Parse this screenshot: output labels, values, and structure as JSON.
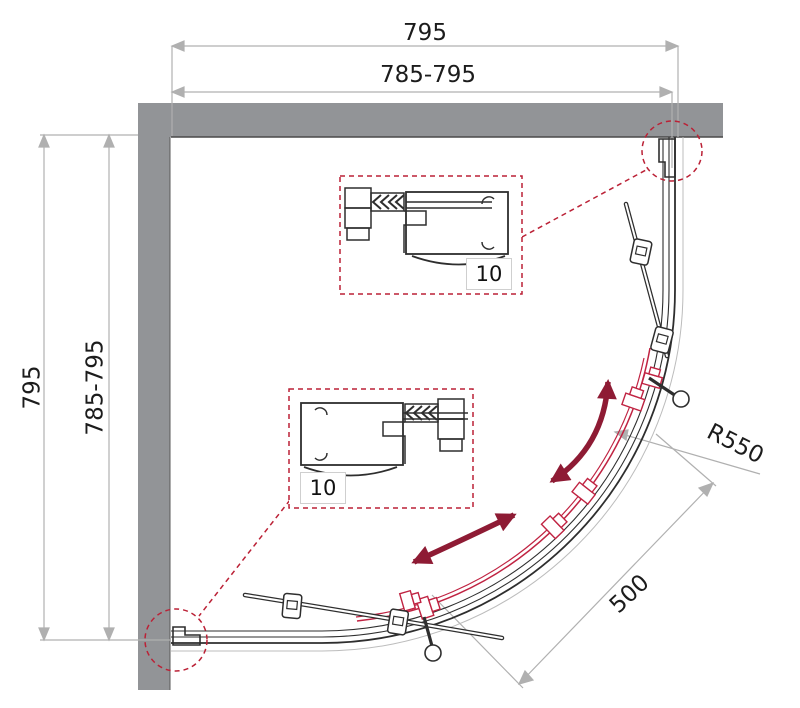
{
  "dimensions": {
    "top_overall": "795",
    "top_adjustable": "785-795",
    "side_overall": "795",
    "side_adjustable": "785-795",
    "radius": "R550",
    "entry_width": "500"
  },
  "callouts": {
    "top_detail_value": "10",
    "bottom_detail_value": "10"
  },
  "colors": {
    "wall_gray": "#929497",
    "line_black": "#2e2e2e",
    "dimension_gray": "#b0b0b0",
    "accent_red": "#bb2136",
    "door_red": "#c02342",
    "arrow_maroon": "#8e1b34"
  }
}
